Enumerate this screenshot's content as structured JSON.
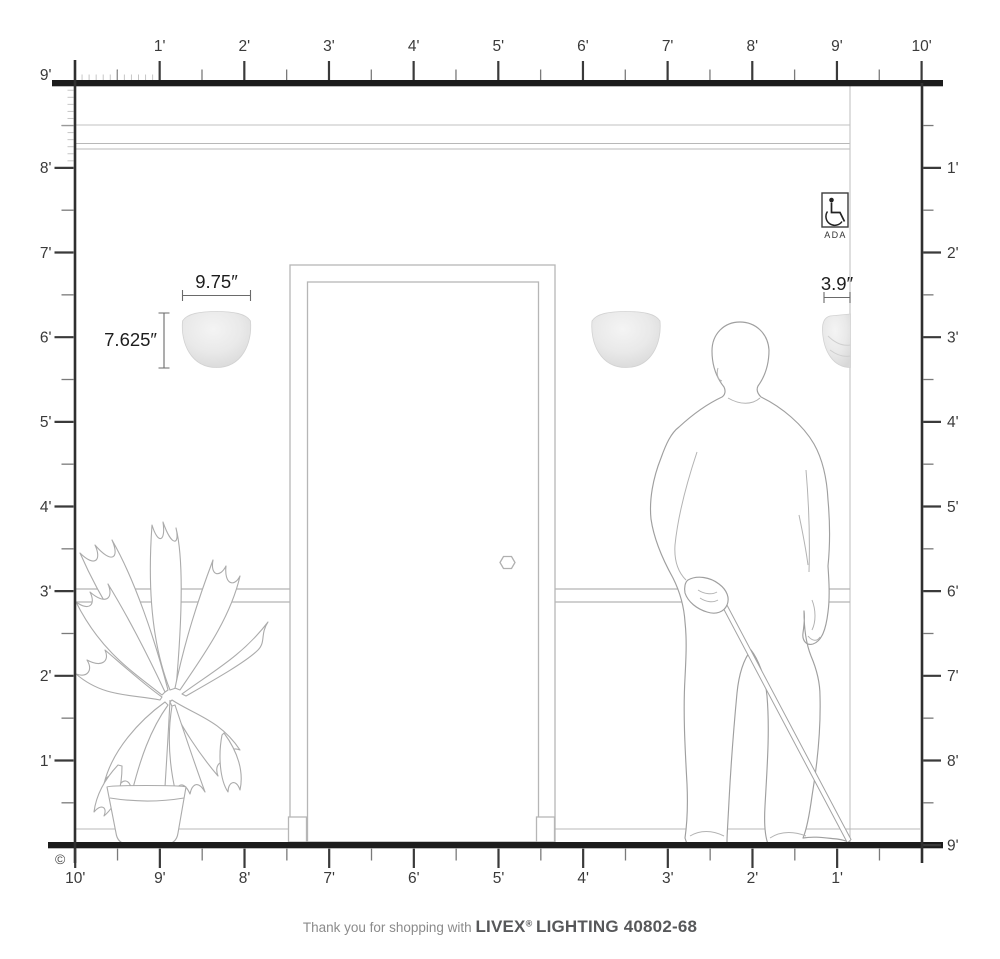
{
  "rulers": {
    "top": {
      "labels": [
        "1'",
        "2'",
        "3'",
        "4'",
        "5'",
        "6'",
        "7'",
        "8'",
        "9'",
        "10'"
      ]
    },
    "left": {
      "labels": [
        "9'",
        "8'",
        "7'",
        "6'",
        "5'",
        "4'",
        "3'",
        "2'",
        "1'"
      ]
    },
    "right": {
      "labels": [
        "1'",
        "2'",
        "3'",
        "4'",
        "5'",
        "6'",
        "7'",
        "8'",
        "9'"
      ]
    },
    "bottom": {
      "labels": [
        "10'",
        "9'",
        "8'",
        "7'",
        "6'",
        "5'",
        "4'",
        "3'",
        "2'",
        "1'"
      ]
    }
  },
  "fixture": {
    "width_label": "9.75″",
    "height_label": "7.625″",
    "depth_label": "3.9″"
  },
  "ada_badge": {
    "label": "ADA"
  },
  "copyright_symbol": "©",
  "footer": {
    "prefix": "Thank you for shopping with",
    "brand": "LIVEX",
    "registered_mark": "®",
    "product": "LIGHTING 40802-68"
  },
  "colors": {
    "ink": "#1c1c1c",
    "ruler_line": "#2f2f2f",
    "tick_major": "#3a3a3a",
    "tick_minor": "#7a7a7a",
    "tick_inch": "#c6c6c6",
    "wall_line": "#c2c2c2",
    "drawing_line": "#a8a8a8",
    "sconce_fill": "#e7e7e7",
    "dim_line": "#6a6a6a"
  }
}
